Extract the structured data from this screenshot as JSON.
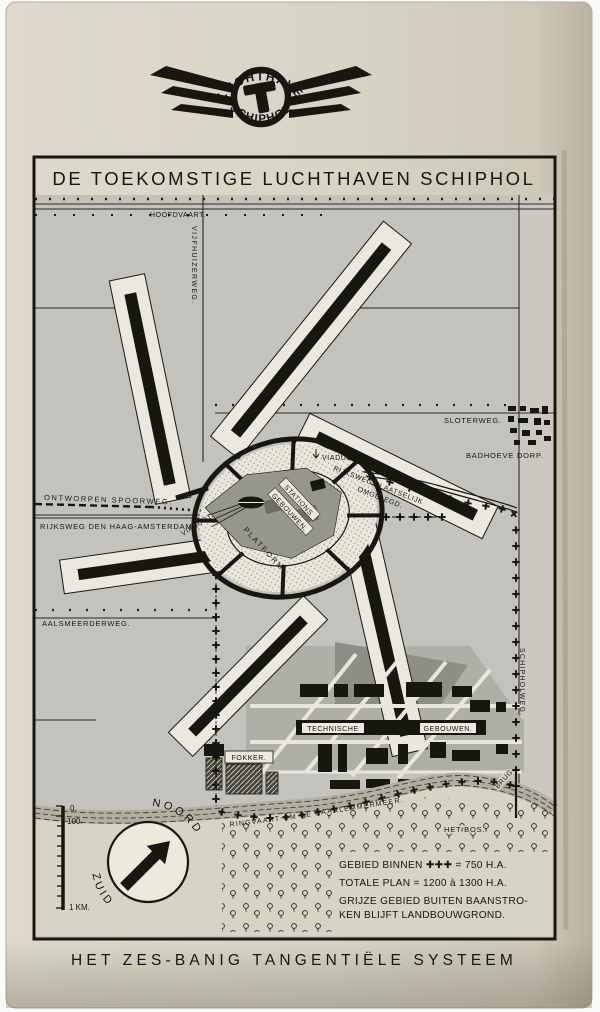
{
  "logo": {
    "top": "LUCHTHAVEN",
    "bottom": "SCHIPHOL"
  },
  "title": "DE TOEKOMSTIGE LUCHTHAVEN SCHIPHOL",
  "caption": "HET ZES-BANIG TANGENTIËLE SYSTEEM",
  "map": {
    "labels": {
      "hoofdvaart": "HOOFDVAART.",
      "vijfhuizerweg": "VIJFHUIZERWEG.",
      "sloterweg": "SLOTERWEG.",
      "badhoeve_dorp": "BADHOEVE DORP.",
      "viaduct": "VIADUCT.",
      "rijksweg_plaatselijk_1": "RIJKSWEG PLAATSELIJK",
      "rijksweg_plaatselijk_2": "OMGELEGD.",
      "ontworpen_spoorweg": "ONTWORPEN SPOORWEG.",
      "rijksweg_den_haag": "RIJKSWEG DEN HAAG-AMSTERDAM.",
      "stations_1": "STATIONS",
      "stations_2": "GEBOUWEN.",
      "platform": "PLATFORM.",
      "aalsmeerderweg": "AALSMEERDERWEG.",
      "schipholweg": "SCHIPHOLWEG.",
      "technische": "TECHNISCHE",
      "gebouwen": "GEBOUWEN.",
      "fokker": "FOKKER.",
      "ringvaart": "RINGVAART OM DE HAARLEMMERMEER.",
      "het_bos": "HET BOS.",
      "brug": "BRUG."
    },
    "compass": {
      "north": "NOORD",
      "south": "ZUID"
    },
    "scale": {
      "zero": "0.",
      "hundred": "100.",
      "km": "1 KM."
    },
    "legend": {
      "line1": "GEBIED BINNEN ✚✚✚ = 750 H.A.",
      "line2": "TOTALE PLAN = 1200 à 1300 H.A.",
      "line3": "GRIJZE GEBIED BUITEN BAANSTRO-",
      "line4": "KEN BLIJFT LANDBOUWGROND."
    },
    "colors": {
      "paper": "#d8d4c6",
      "map_gray": "#c3c2bc",
      "runway_light": "#ebe8dd",
      "ink": "#1b1a17"
    }
  }
}
